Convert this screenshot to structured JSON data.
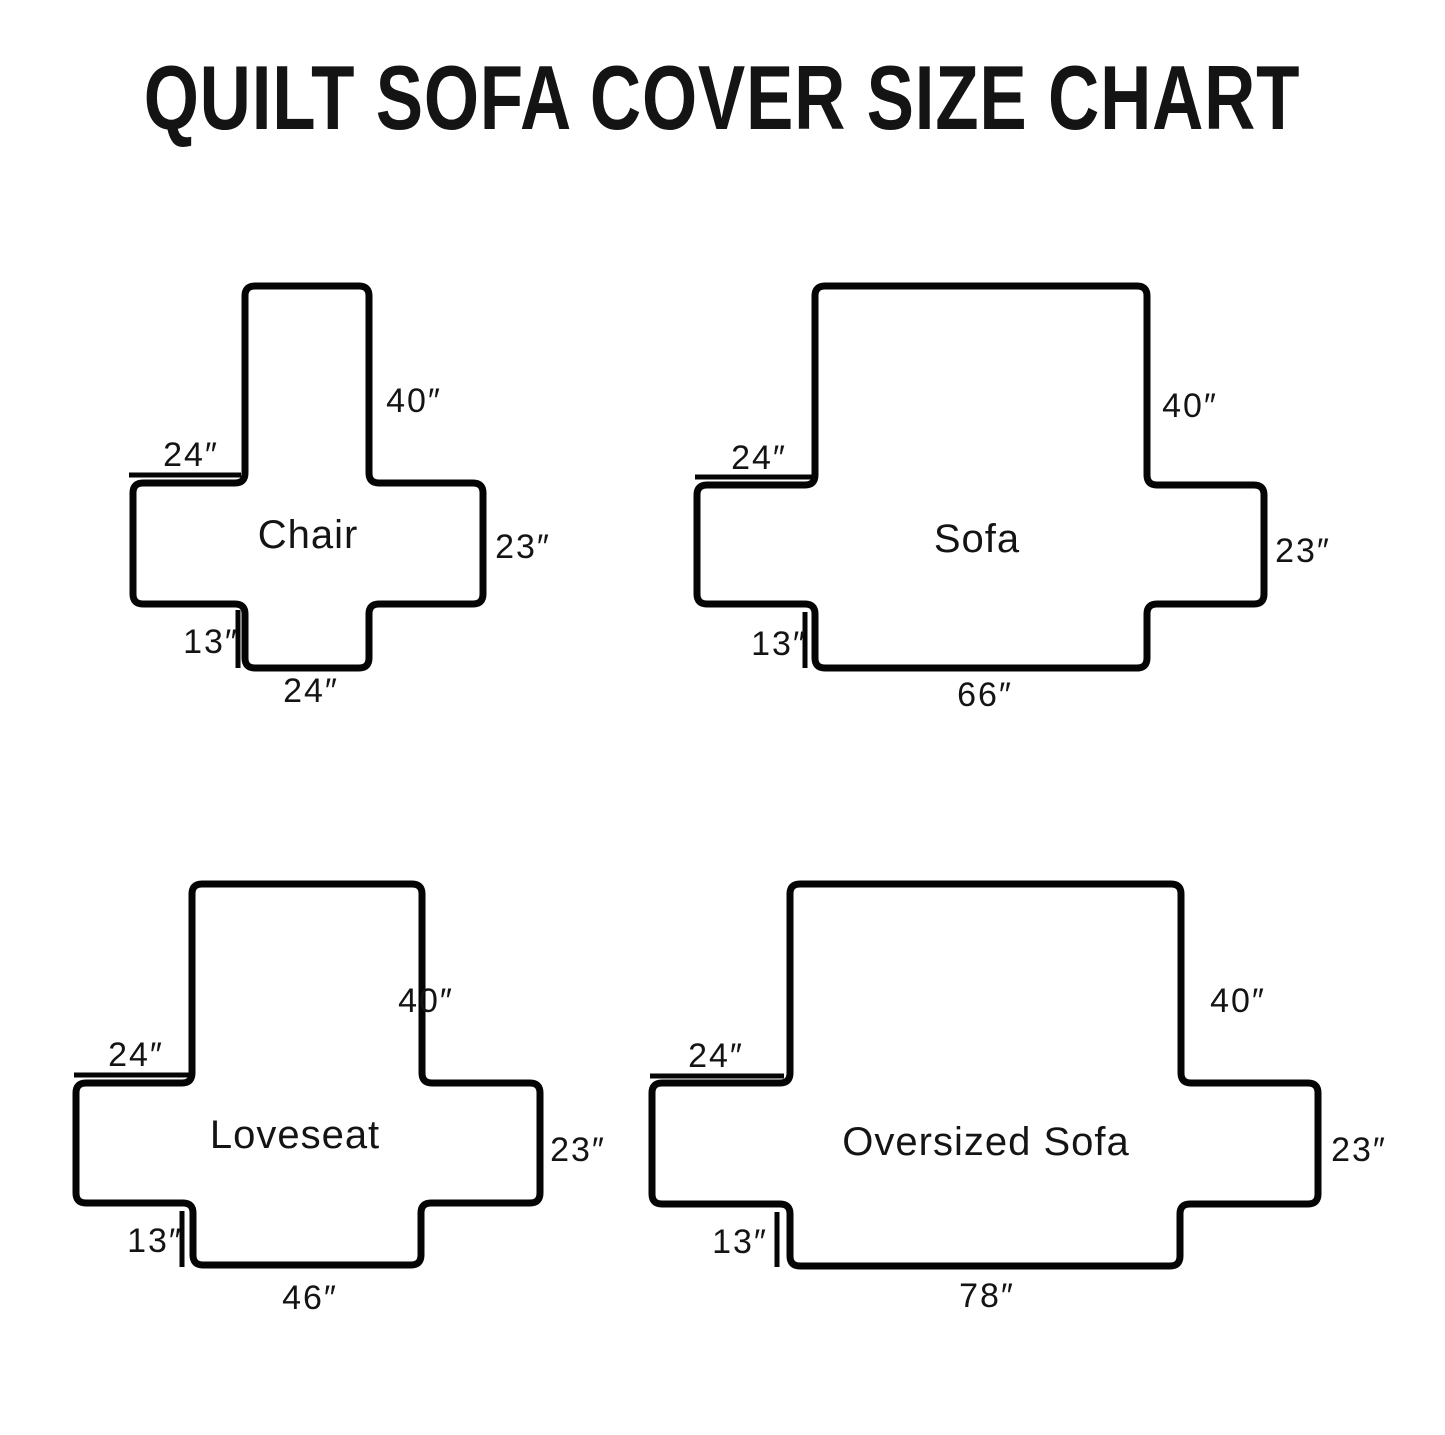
{
  "title": "QUILT SOFA COVER SIZE CHART",
  "colors": {
    "line": "#050505",
    "background": "#ffffff"
  },
  "diagrams": [
    {
      "name": "Chair",
      "back_length": "40″",
      "arm_front_width": "24″",
      "seat_side_depth": "23″",
      "front_skirt_drop": "13″",
      "seat_front_width": "24″"
    },
    {
      "name": "Sofa",
      "back_length": "40″",
      "arm_front_width": "24″",
      "seat_side_depth": "23″",
      "front_skirt_drop": "13″",
      "seat_front_width": "66″"
    },
    {
      "name": "Loveseat",
      "back_length": "40″",
      "arm_front_width": "24″",
      "seat_side_depth": "23″",
      "front_skirt_drop": "13″",
      "seat_front_width": "46″"
    },
    {
      "name": "Oversized Sofa",
      "back_length": "40″",
      "arm_front_width": "24″",
      "seat_side_depth": "23″",
      "front_skirt_drop": "13″",
      "seat_front_width": "78″"
    }
  ]
}
